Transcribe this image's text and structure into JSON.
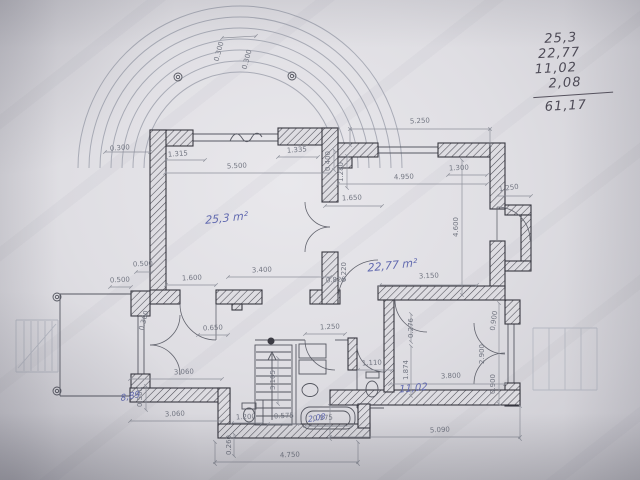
{
  "photo": {
    "paper_color": "#dfdee3"
  },
  "notes": {
    "items": [
      "25,3",
      "22,77",
      "11,02",
      "2,08"
    ],
    "total": "61,17"
  },
  "plan": {
    "wall_ink_color": "#2f2f38",
    "dimension_ink_color": "#6e727e",
    "room_label_ink_color": "#5b64ad",
    "pencil_color": "#4d4a56",
    "room_labels": [
      {
        "t": "25,3 m²",
        "x": 246,
        "y": 197,
        "r": -6,
        "s": 11
      },
      {
        "t": "22,77 m²",
        "x": 414,
        "y": 227,
        "r": -6,
        "s": 11
      },
      {
        "t": "8,89",
        "x": 199,
        "y": 352,
        "r": -12,
        "s": 9
      },
      {
        "t": "2,08",
        "x": 372,
        "y": 352,
        "r": -10,
        "s": 8
      },
      {
        "t": "11,02",
        "x": 447,
        "y": 344,
        "r": -6,
        "s": 10
      }
    ],
    "dimensions": [
      {
        "t": "0.300",
        "x": 120,
        "y": 150,
        "r": -4
      },
      {
        "t": "1.315",
        "x": 178,
        "y": 156,
        "r": -4
      },
      {
        "t": "1.335",
        "x": 297,
        "y": 152,
        "r": -4
      },
      {
        "t": "5.500",
        "x": 237,
        "y": 168,
        "r": -3
      },
      {
        "t": "5.250",
        "x": 420,
        "y": 123,
        "r": -3
      },
      {
        "t": "4.950",
        "x": 404,
        "y": 179,
        "r": -3
      },
      {
        "t": "1.300",
        "x": 459,
        "y": 170,
        "r": -3
      },
      {
        "t": "1.250",
        "x": 509,
        "y": 190,
        "r": -8
      },
      {
        "t": "0.400",
        "x": 330,
        "y": 161,
        "r": -90
      },
      {
        "t": "1.280",
        "x": 343,
        "y": 172,
        "r": -90
      },
      {
        "t": "1.650",
        "x": 352,
        "y": 200,
        "r": -3
      },
      {
        "t": "4.600",
        "x": 458,
        "y": 227,
        "r": -90
      },
      {
        "t": "3.150",
        "x": 429,
        "y": 278,
        "r": -3
      },
      {
        "t": "3.400",
        "x": 262,
        "y": 272,
        "r": -3
      },
      {
        "t": "0.820",
        "x": 336,
        "y": 282,
        "r": -3
      },
      {
        "t": "0.220",
        "x": 346,
        "y": 272,
        "r": -90
      },
      {
        "t": "0.500",
        "x": 143,
        "y": 266,
        "r": -3
      },
      {
        "t": "0.500",
        "x": 120,
        "y": 282,
        "r": -3
      },
      {
        "t": "1.600",
        "x": 192,
        "y": 280,
        "r": -3
      },
      {
        "t": "0.300",
        "x": 146,
        "y": 321,
        "r": -75
      },
      {
        "t": "0.650",
        "x": 213,
        "y": 330,
        "r": -3
      },
      {
        "t": "1.250",
        "x": 330,
        "y": 329,
        "r": -3
      },
      {
        "t": "0.276",
        "x": 413,
        "y": 328,
        "r": -90
      },
      {
        "t": "0.900",
        "x": 496,
        "y": 321,
        "r": -82
      },
      {
        "t": "2.900",
        "x": 484,
        "y": 354,
        "r": -90
      },
      {
        "t": "0.900",
        "x": 495,
        "y": 384,
        "r": -90
      },
      {
        "t": "1.874",
        "x": 408,
        "y": 370,
        "r": -90
      },
      {
        "t": "1.110",
        "x": 372,
        "y": 365,
        "r": -3
      },
      {
        "t": "3.800",
        "x": 451,
        "y": 378,
        "r": -3
      },
      {
        "t": "3.060",
        "x": 184,
        "y": 374,
        "r": -3
      },
      {
        "t": "3.060",
        "x": 175,
        "y": 416,
        "r": -3
      },
      {
        "t": "0.500",
        "x": 142,
        "y": 397,
        "r": -90
      },
      {
        "t": "3.105",
        "x": 275,
        "y": 380,
        "r": -90
      },
      {
        "t": "1.200",
        "x": 246,
        "y": 419,
        "r": -3
      },
      {
        "t": "0.575",
        "x": 284,
        "y": 418,
        "r": -3
      },
      {
        "t": "0.575",
        "x": 323,
        "y": 420,
        "r": -3
      },
      {
        "t": "0.260",
        "x": 231,
        "y": 445,
        "r": -90
      },
      {
        "t": "4.750",
        "x": 290,
        "y": 457,
        "r": -3
      },
      {
        "t": "5.090",
        "x": 440,
        "y": 432,
        "r": -3
      },
      {
        "t": "0.300",
        "x": 221,
        "y": 52,
        "r": -75
      },
      {
        "t": "0.300",
        "x": 249,
        "y": 60,
        "r": -75
      }
    ]
  }
}
